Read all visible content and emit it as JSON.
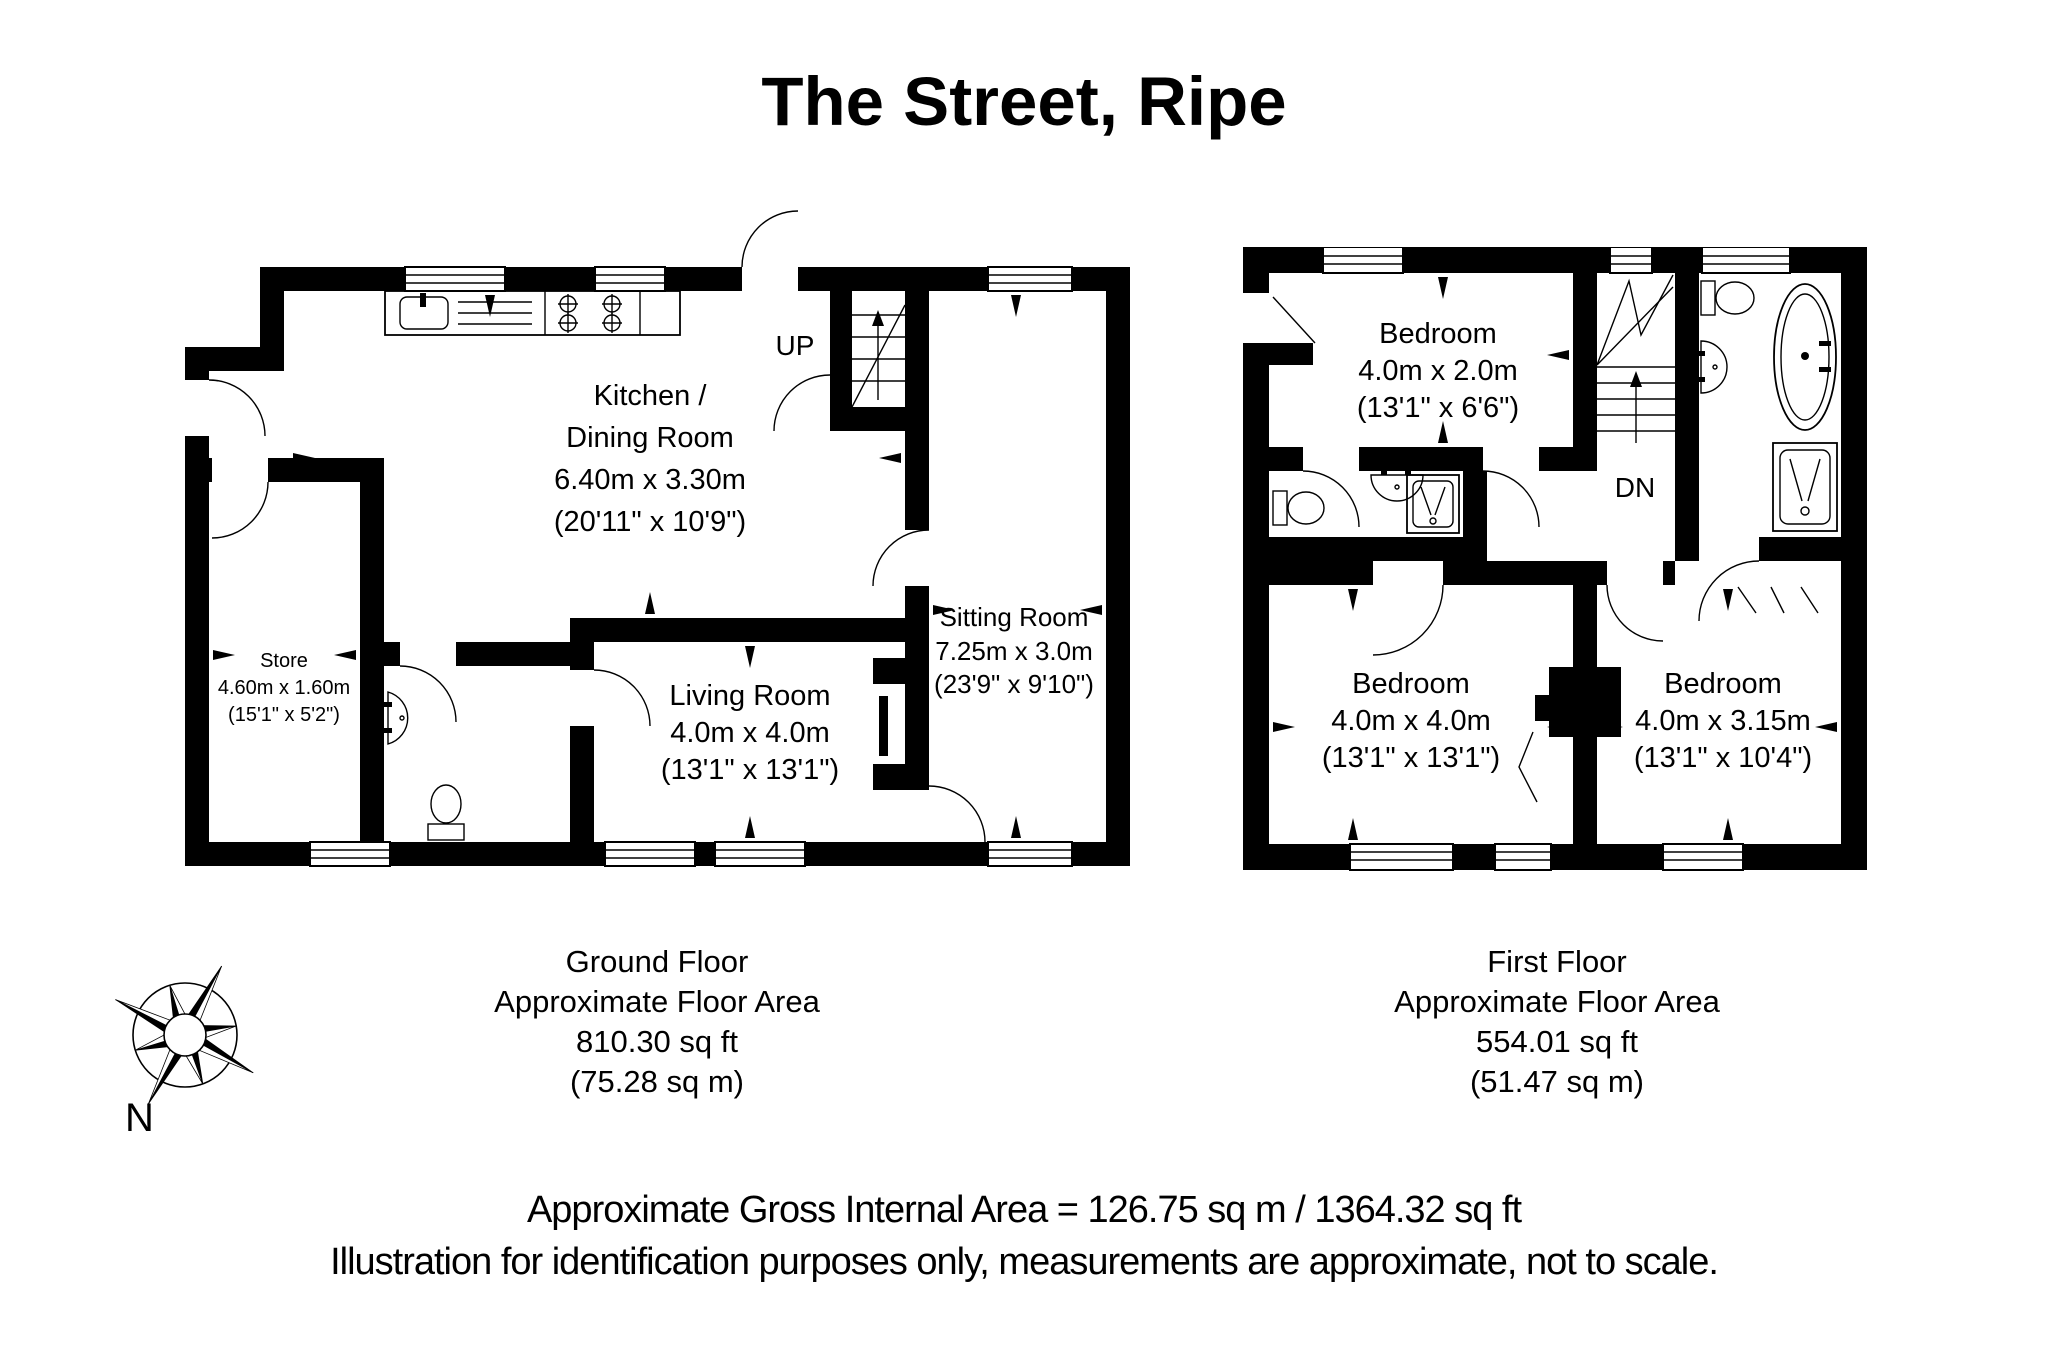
{
  "title": "The Street, Ripe",
  "colors": {
    "wall": "#000000",
    "background": "#ffffff"
  },
  "ground_floor": {
    "stairs_label": "UP",
    "rooms": {
      "kitchen": {
        "line1": "Kitchen /",
        "line2": "Dining Room",
        "metric": "6.40m x 3.30m",
        "imperial": "(20'11\" x 10'9\")"
      },
      "sitting": {
        "name": "Sitting Room",
        "metric": "7.25m x 3.0m",
        "imperial": "(23'9\" x 9'10\")"
      },
      "living": {
        "name": "Living Room",
        "metric": "4.0m x 4.0m",
        "imperial": "(13'1\" x 13'1\")"
      },
      "store": {
        "name": "Store",
        "metric": "4.60m x 1.60m",
        "imperial": "(15'1\" x 5'2\")"
      }
    },
    "caption": {
      "floor": "Ground Floor",
      "area_label": "Approximate Floor Area",
      "area_ft": "810.30 sq ft",
      "area_m": "(75.28 sq m)"
    }
  },
  "first_floor": {
    "stairs_label": "DN",
    "rooms": {
      "bedroom1": {
        "name": "Bedroom",
        "metric": "4.0m x 2.0m",
        "imperial": "(13'1\" x 6'6\")"
      },
      "bedroom2": {
        "name": "Bedroom",
        "metric": "4.0m x 4.0m",
        "imperial": "(13'1\" x 13'1\")"
      },
      "bedroom3": {
        "name": "Bedroom",
        "metric": "4.0m x 3.15m",
        "imperial": "(13'1\" x 10'4\")"
      }
    },
    "caption": {
      "floor": "First Floor",
      "area_label": "Approximate Floor Area",
      "area_ft": "554.01 sq ft",
      "area_m": "(51.47 sq m)"
    }
  },
  "compass": {
    "north_label": "N"
  },
  "footer": {
    "line1": "Approximate Gross Internal Area = 126.75 sq m / 1364.32 sq ft",
    "line2": "Illustration for identification purposes only, measurements are approximate, not to scale."
  }
}
